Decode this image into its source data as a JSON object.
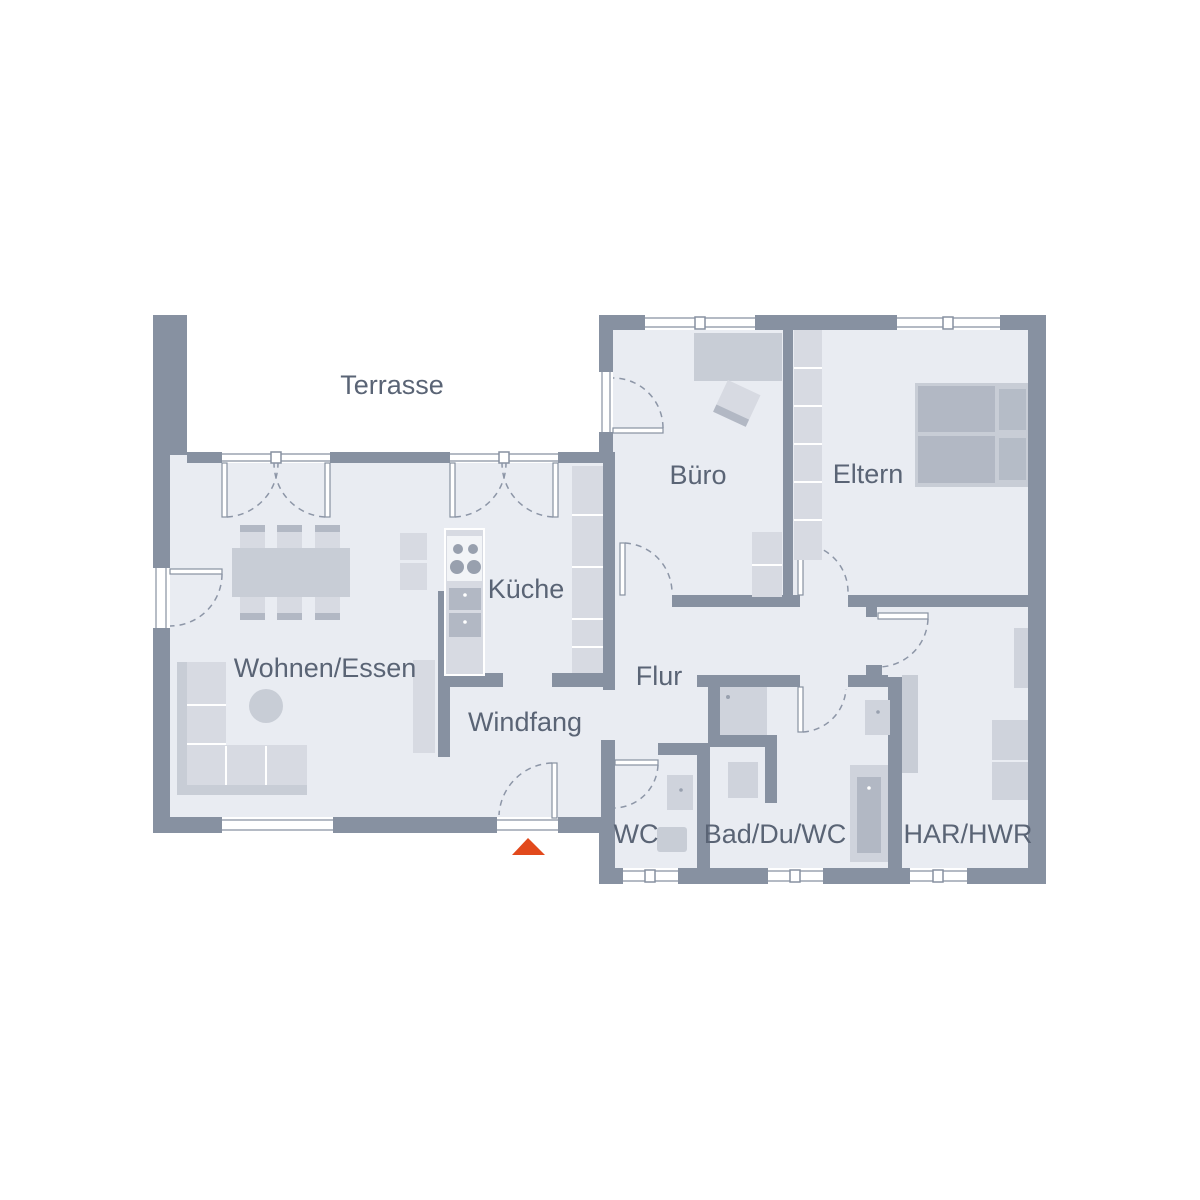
{
  "plan_type": "floor-plan",
  "rooms": [
    {
      "id": "terrasse",
      "label": "Terrasse"
    },
    {
      "id": "wohnen-essen",
      "label": "Wohnen/Essen"
    },
    {
      "id": "kueche",
      "label": "Küche"
    },
    {
      "id": "windfang",
      "label": "Windfang"
    },
    {
      "id": "flur",
      "label": "Flur"
    },
    {
      "id": "buero",
      "label": "Büro"
    },
    {
      "id": "eltern",
      "label": "Eltern"
    },
    {
      "id": "wc",
      "label": "WC"
    },
    {
      "id": "bad",
      "label": "Bad/Du/WC"
    },
    {
      "id": "har-hwr",
      "label": "HAR/HWR"
    }
  ],
  "entrance_marker": {
    "shape": "triangle",
    "meaning": "entrance-direction-marker"
  },
  "colors": {
    "wall": "#8791a1",
    "floor": "#e9ecf2",
    "furn_light": "#d7dae2",
    "furn_mid": "#c8cdd6",
    "furn_dark": "#b2b8c4",
    "fixture": "#cfd3dc",
    "label": "#5a6475",
    "accent": "#e2491c",
    "arc": "#8d96a7",
    "dot": "#98a0ae"
  }
}
